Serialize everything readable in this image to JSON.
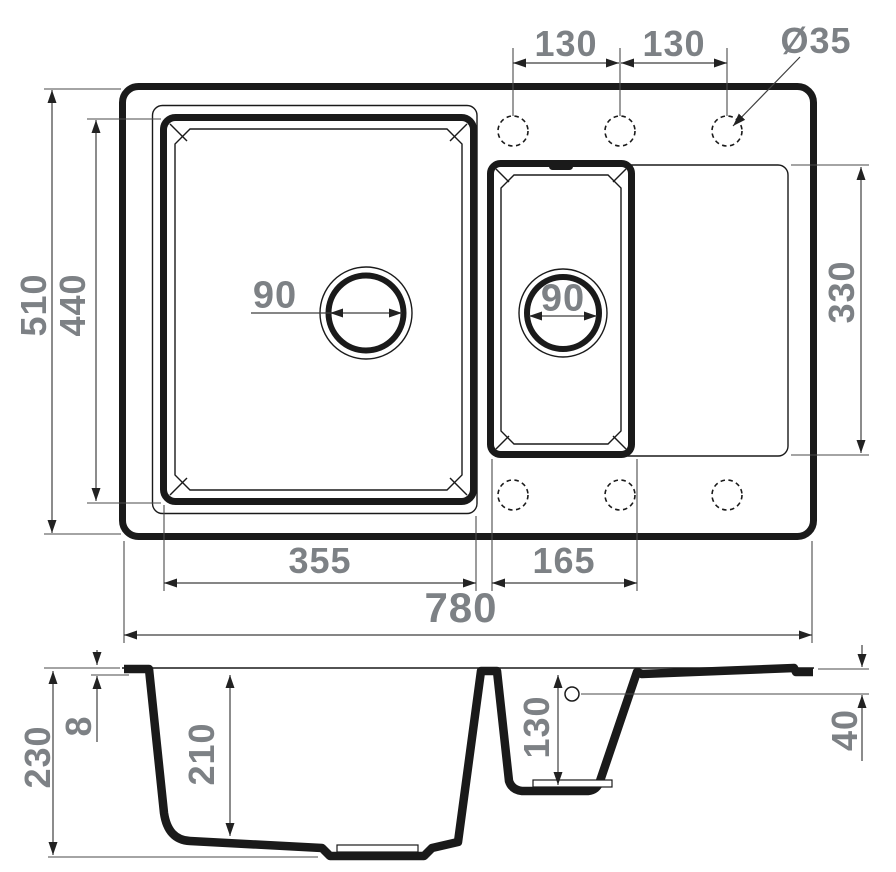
{
  "top_view": {
    "faucet_holes": {
      "spacing_left": "130",
      "spacing_right": "130",
      "diameter": "Ø35"
    },
    "overall_width": "780",
    "overall_depth": "510",
    "main_bowl": {
      "inner_width": "355",
      "inner_depth": "440",
      "drain_diameter": "90"
    },
    "small_bowl": {
      "inner_width": "165",
      "drain_diameter": "90"
    },
    "right_section_depth": "330"
  },
  "section_view": {
    "overall_height": "230",
    "rim_thickness": "8",
    "main_bowl_depth": "210",
    "small_bowl_depth": "130",
    "drainboard_drop": "40"
  },
  "colors": {
    "line": "#1a1a1a",
    "dimension_text": "#7d8185",
    "background": "#ffffff"
  }
}
